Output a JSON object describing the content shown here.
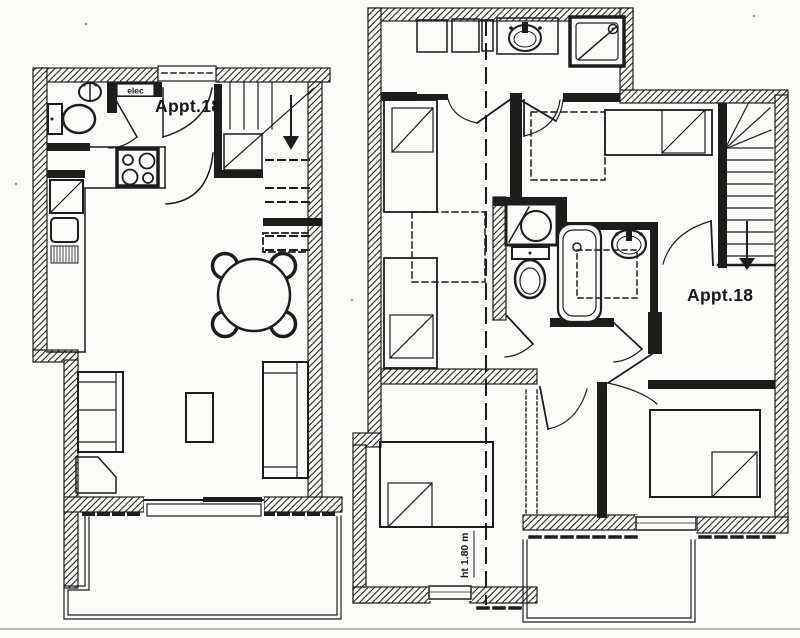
{
  "colors": {
    "ink": "#1d1d1b",
    "paper": "#fbfbf8",
    "scan_line": "#bdbdb4"
  },
  "left_plan": {
    "apartment_label": "Appt.18",
    "elec_label": "elec",
    "fixtures": [
      "toilet",
      "hand-washbasin",
      "electric-panel",
      "entrance-door",
      "staircase-with-down-arrow",
      "cooktop-4-burners",
      "refrigerator",
      "kitchen-sink-with-drainer",
      "round-dining-table-4-chairs",
      "sofa",
      "armchair",
      "coffee-table",
      "bench-sofa",
      "window",
      "balcony-with-dashed-railing"
    ]
  },
  "right_plan": {
    "apartment_label": "Appt.18",
    "height_label": "ht 1.80 m",
    "fixtures": [
      "wardrobes",
      "washbasin-on-counter",
      "shower",
      "single-bed",
      "single-bed",
      "skylight-dashed",
      "skylight-dashed",
      "corner-washbasin",
      "toilet",
      "bathtub",
      "washbasin",
      "double-bed",
      "double-bed",
      "staircase-with-down-arrow",
      "windows",
      "balcony-with-dashed-railing",
      "roof-height-line"
    ]
  }
}
